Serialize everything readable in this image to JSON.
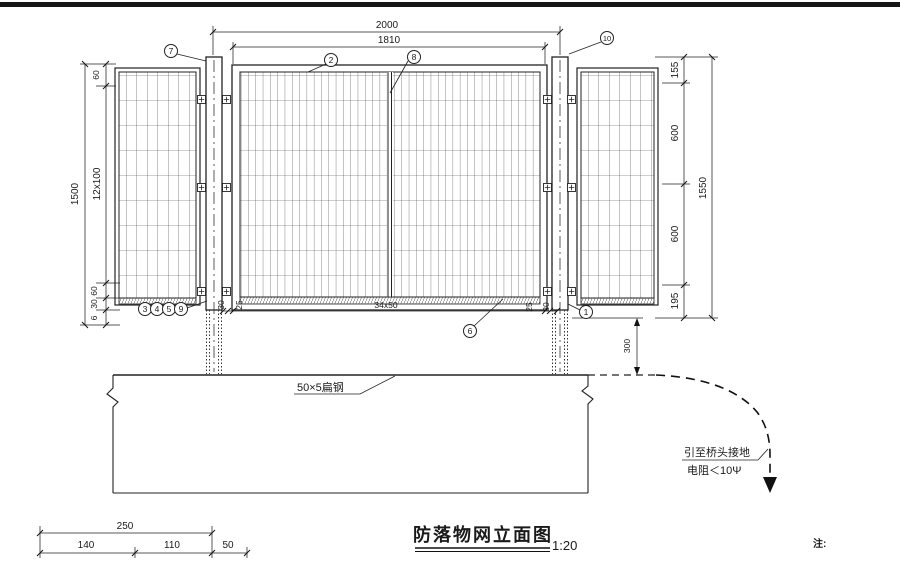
{
  "dwg": {
    "title": "防落物网立面图",
    "scale": "1:20",
    "note": "注:",
    "flat_steel_label": "50×5扁钢",
    "grounding": {
      "l1": "引至桥头接地",
      "l2": "电阻＜10Ψ"
    },
    "callouts": {
      "n1": "1",
      "n2": "2",
      "n3": "3",
      "n4": "4",
      "n5": "5",
      "n6": "6",
      "n7": "7",
      "n8": "8",
      "n9": "9",
      "n10": "10"
    },
    "dims": {
      "top_overall": "2000",
      "top_inner": "1810",
      "left_overall": "1500",
      "left_top": "60",
      "left_mid": "12x100",
      "left_b1": "60",
      "left_b2": "30",
      "left_b3": "6",
      "right_overall": "1550",
      "right_s1": "155",
      "right_s2": "600",
      "right_s3": "600",
      "right_s4": "195",
      "rail_1": "30",
      "rail_2": "25",
      "rail_3": "34x50",
      "rail_4": "25",
      "rail_5": "30",
      "embed": "300",
      "foot_overall": "250",
      "foot_1": "140",
      "foot_2": "110",
      "foot_3": "50"
    },
    "colors": {
      "line": "#1a1a1a",
      "bg": "#ffffff"
    }
  }
}
